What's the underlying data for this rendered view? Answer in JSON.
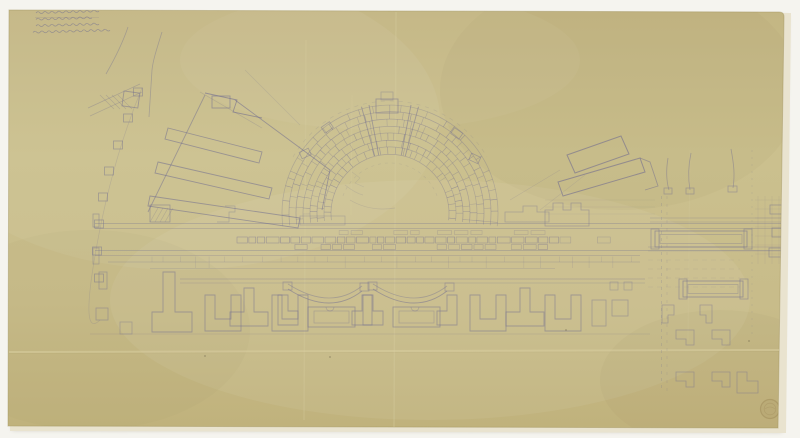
{
  "artwork": {
    "kind": "hand-drawn archaeological excavation plan on aged tracing paper",
    "subject": "semicircular theater cavea with stage building, flanking halls, tabernae row and twin exedrae"
  },
  "handwritten_note": {
    "location": "top-left",
    "line_count": 4,
    "transcription": "illegible faint pencil handwriting",
    "underlined_first_line": true
  },
  "stamp": {
    "location": "bottom-right",
    "shape": "circular",
    "description": "faint embossed collection stamp"
  },
  "palette": {
    "background": "#f5f4ef",
    "backing_sheet": "#e9e3cf",
    "paper": "#c8bc8a",
    "paper_light": "#cfc494",
    "paper_dark": "#bcae7a",
    "edge": "#a2945f",
    "ink": "#716d90",
    "crease_light": "#d8cda0",
    "crease_dark": "#8d7f4f",
    "stamp_ink": "#9d8a58"
  },
  "plan_features": [
    "theater-cavea",
    "orchestra",
    "stage-building-band",
    "western-hall-complex",
    "column-base-row",
    "top-left-roads",
    "eastern-slanted-buildings",
    "eastern-room-grid",
    "tabernae-row",
    "twin-exedrae",
    "bottom-right-piers"
  ]
}
